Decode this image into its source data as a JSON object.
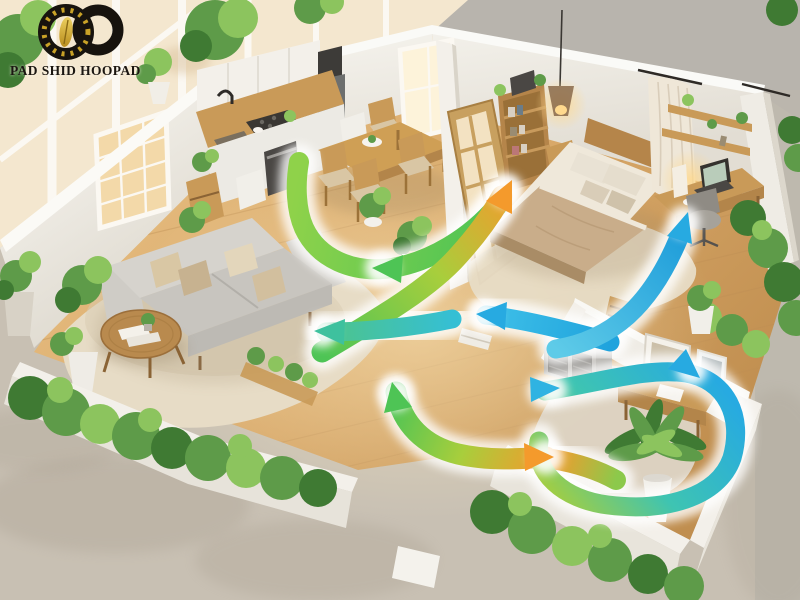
{
  "brand": {
    "wordmark": "PAD SHID HOOPAD"
  },
  "scene": {
    "description": "Isometric 3D cutaway rendering of an apartment showing natural cross-ventilation: gradient airflow arrows weave from the living and dining areas through the bedroom, office nook and study room",
    "rooms": [
      "balcony-sunroom",
      "kitchen",
      "dining-area",
      "living-room",
      "bedroom",
      "office-nook",
      "study-room",
      "garden-perimeter"
    ],
    "airflow_legend": [
      {
        "name": "warm-outgoing-air",
        "color": "#f49a2c"
      },
      {
        "name": "fresh-air",
        "color": "#4ec455"
      },
      {
        "name": "cool-incoming-air",
        "color": "#27aae1"
      }
    ]
  },
  "colors": {
    "flow-warm": "#f49a2c",
    "flow-fresh": "#4ec455",
    "flow-cool": "#27aae1",
    "flow-lime": "#a8ce3c",
    "wall": "#f3f0ea",
    "wall-shade": "#ddd8ce",
    "pavement": "#c8c0b3",
    "pavement-shade": "#b3aa9c",
    "rug": "#e7dcc6",
    "foliage": "#5e9b49",
    "foliage-dark": "#3f7a33",
    "foliage-light": "#8cc45e"
  }
}
